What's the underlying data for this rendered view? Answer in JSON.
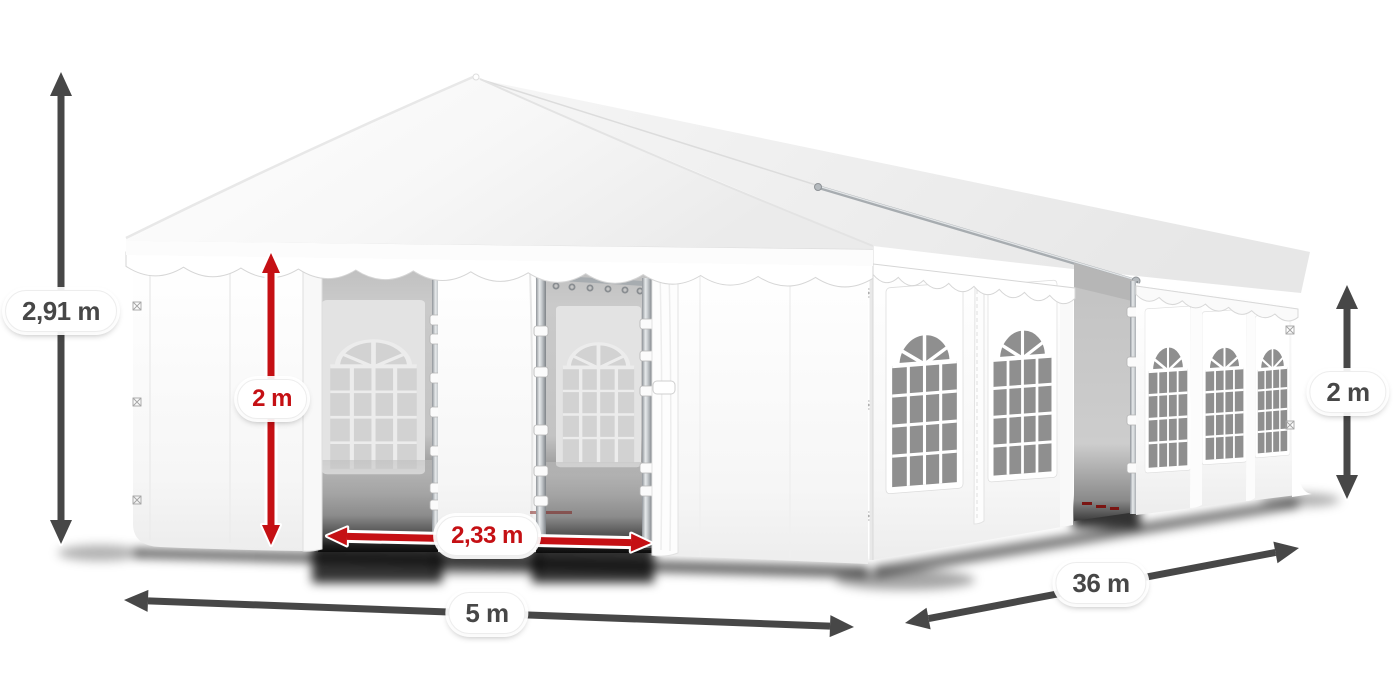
{
  "illustration": {
    "name": "party-tent-dimensions",
    "alt": "White 5 x 36 m party tent with open front entrance doors, scalloped valances and arched windows, annotated with dimension arrows",
    "colors": {
      "accent_red": "#c51014",
      "dimension_gray": "#474747",
      "pane_gray": "#8f8f8f"
    }
  },
  "dimensions": {
    "total_height": {
      "label": "2,91 m",
      "style": "dark"
    },
    "front_wall_height": {
      "label": "2 m",
      "style": "red"
    },
    "entrance_width": {
      "label": "2,33 m",
      "style": "red"
    },
    "front_width": {
      "label": "5 m",
      "style": "dark"
    },
    "side_length": {
      "label": "36 m",
      "style": "dark"
    },
    "side_wall_height": {
      "label": "2 m",
      "style": "dark"
    }
  }
}
